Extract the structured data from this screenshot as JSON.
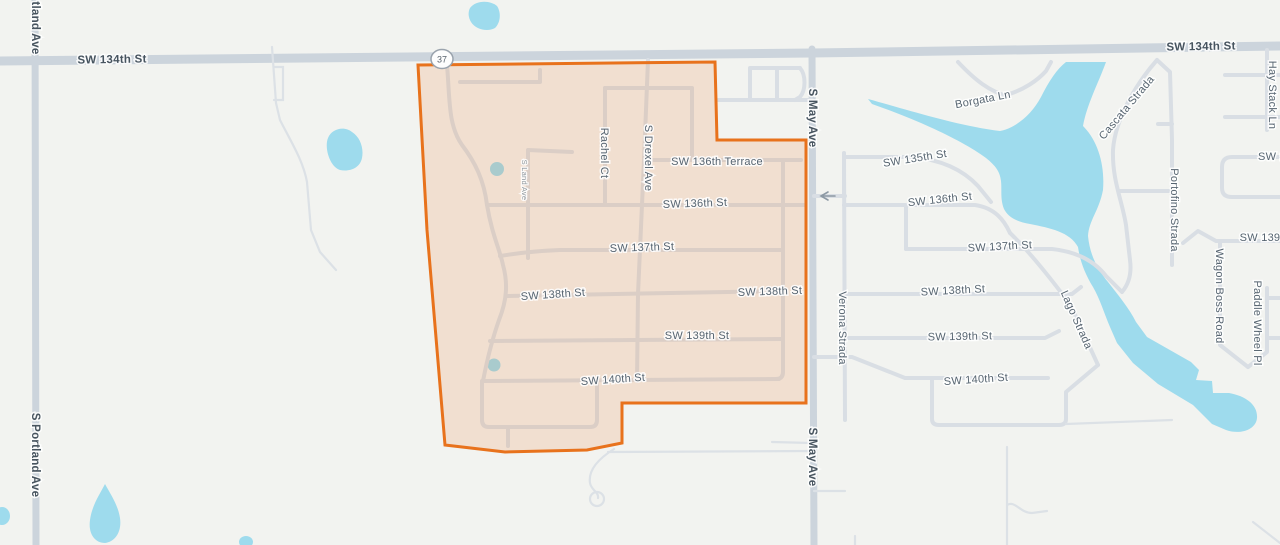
{
  "map": {
    "colors": {
      "background": "#f2f3f0",
      "water": "#9edbed",
      "road": "#d9dee4",
      "major_road": "#ccd4dc",
      "selection_accent": "#e8721c",
      "label_text": "#566470"
    },
    "highway_shield": {
      "route": "37"
    },
    "one_way_arrow_direction": "left",
    "labels": [
      {
        "id": "sw134-left",
        "text": "SW 134th St",
        "x": 112,
        "y": 60,
        "rotate": -1,
        "cls": "lbl-major"
      },
      {
        "id": "sw134-right",
        "text": "SW 134th St",
        "x": 1201,
        "y": 47,
        "rotate": -1,
        "cls": "lbl-major"
      },
      {
        "id": "portland-top",
        "text": "tland Ave",
        "x": 35,
        "y": 28,
        "rotate": 90,
        "cls": "lbl-major"
      },
      {
        "id": "portland-mid",
        "text": "S Portland Ave",
        "x": 35,
        "y": 455,
        "rotate": 90,
        "cls": "lbl-major"
      },
      {
        "id": "may-top",
        "text": "S May Ave",
        "x": 812,
        "y": 118,
        "rotate": 90,
        "cls": "lbl-major"
      },
      {
        "id": "may-bottom",
        "text": "S May Ave",
        "x": 812,
        "y": 457,
        "rotate": 90,
        "cls": "lbl-major"
      },
      {
        "id": "rachel-ct",
        "text": "Rachel Ct",
        "x": 604,
        "y": 153,
        "rotate": 90,
        "cls": ""
      },
      {
        "id": "drexel-ave",
        "text": "S Drexel Ave",
        "x": 648,
        "y": 158,
        "rotate": 90,
        "cls": ""
      },
      {
        "id": "land-ave",
        "text": "S Land Ave",
        "x": 524,
        "y": 180,
        "rotate": 90,
        "cls": "lbl-small"
      },
      {
        "id": "sw136-terr",
        "text": "SW 136th Terrace",
        "x": 717,
        "y": 162,
        "rotate": 0,
        "cls": ""
      },
      {
        "id": "sw136-left",
        "text": "SW 136th St",
        "x": 695,
        "y": 204,
        "rotate": -2,
        "cls": ""
      },
      {
        "id": "sw137-left",
        "text": "SW 137th St",
        "x": 642,
        "y": 248,
        "rotate": -2,
        "cls": ""
      },
      {
        "id": "sw138-left",
        "text": "SW 138th St",
        "x": 553,
        "y": 295,
        "rotate": -4,
        "cls": ""
      },
      {
        "id": "sw138-mid",
        "text": "SW 138th St",
        "x": 770,
        "y": 292,
        "rotate": -2,
        "cls": ""
      },
      {
        "id": "sw139-mid",
        "text": "SW 139th St",
        "x": 697,
        "y": 336,
        "rotate": 0,
        "cls": ""
      },
      {
        "id": "sw140-mid",
        "text": "SW 140th St",
        "x": 613,
        "y": 380,
        "rotate": -4,
        "cls": ""
      },
      {
        "id": "verona",
        "text": "Verona Strada",
        "x": 842,
        "y": 328,
        "rotate": 90,
        "cls": ""
      },
      {
        "id": "sw135-right",
        "text": "SW 135th St",
        "x": 915,
        "y": 159,
        "rotate": -9,
        "cls": ""
      },
      {
        "id": "sw136-right",
        "text": "SW 136th St",
        "x": 940,
        "y": 200,
        "rotate": -6,
        "cls": ""
      },
      {
        "id": "sw137-right",
        "text": "SW 137th St",
        "x": 1000,
        "y": 247,
        "rotate": -3,
        "cls": ""
      },
      {
        "id": "sw138-right",
        "text": "SW 138th St",
        "x": 953,
        "y": 291,
        "rotate": -3,
        "cls": ""
      },
      {
        "id": "sw139-right",
        "text": "SW 139th St",
        "x": 960,
        "y": 337,
        "rotate": -1,
        "cls": ""
      },
      {
        "id": "sw140-right",
        "text": "SW 140th St",
        "x": 976,
        "y": 380,
        "rotate": -4,
        "cls": ""
      },
      {
        "id": "borgata-ln",
        "text": "Borgata Ln",
        "x": 983,
        "y": 100,
        "rotate": -11,
        "cls": ""
      },
      {
        "id": "cascata",
        "text": "Cascata Strada",
        "x": 1127,
        "y": 108,
        "rotate": -50,
        "cls": ""
      },
      {
        "id": "portofino",
        "text": "Portofino Strada",
        "x": 1174,
        "y": 210,
        "rotate": 90,
        "cls": ""
      },
      {
        "id": "lago",
        "text": "Lago Strada",
        "x": 1076,
        "y": 320,
        "rotate": 66,
        "cls": ""
      },
      {
        "id": "haystack",
        "text": "Hay Stack Ln",
        "x": 1272,
        "y": 95,
        "rotate": 90,
        "cls": ""
      },
      {
        "id": "wagon-boss",
        "text": "Wagon Boss Road",
        "x": 1219,
        "y": 296,
        "rotate": 90,
        "cls": ""
      },
      {
        "id": "paddle-wheel",
        "text": "Paddle Wheel Pl",
        "x": 1257,
        "y": 323,
        "rotate": 90,
        "cls": ""
      },
      {
        "id": "sw-frag",
        "text": "SW 1",
        "x": 1272,
        "y": 157,
        "rotate": 0,
        "cls": ""
      },
      {
        "id": "sw139-frag",
        "text": "SW 139",
        "x": 1260,
        "y": 238,
        "rotate": 0,
        "cls": ""
      }
    ]
  }
}
